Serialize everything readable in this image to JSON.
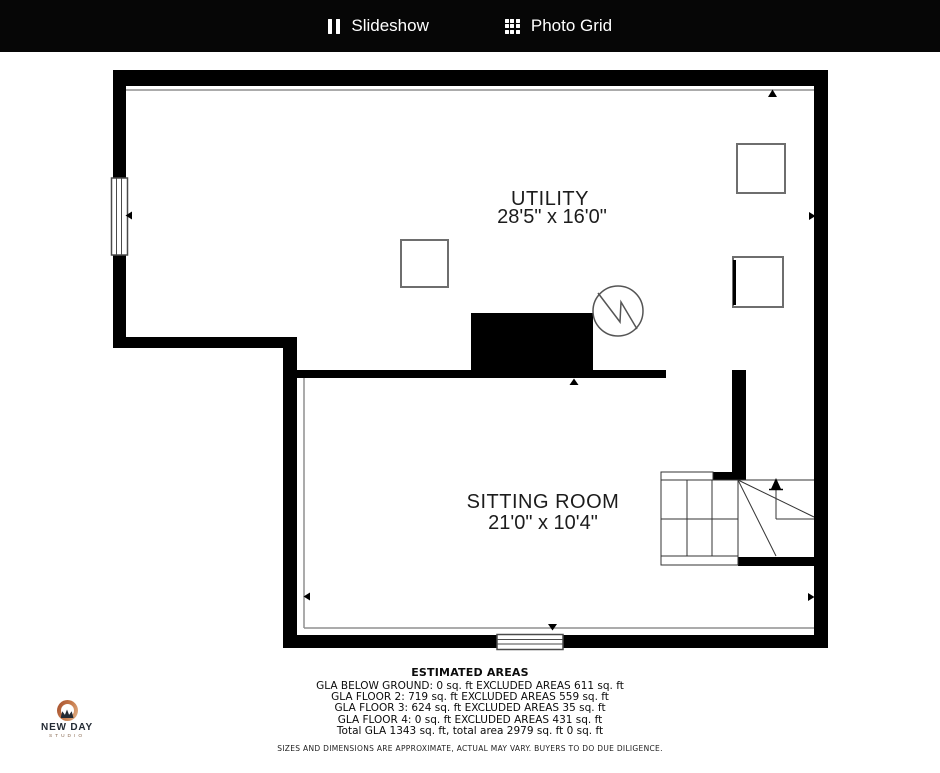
{
  "header": {
    "slideshow_label": "Slideshow",
    "photo_grid_label": "Photo Grid"
  },
  "floorplan": {
    "rooms": [
      {
        "name": "UTILITY",
        "dimensions": "28'5\" x 16'0\""
      },
      {
        "name": "SITTING ROOM",
        "dimensions": "21'0\" x 10'4\""
      }
    ]
  },
  "estimated_areas": {
    "title": "ESTIMATED AREAS",
    "lines": [
      "GLA BELOW GROUND: 0 sq. ft EXCLUDED AREAS 611 sq. ft",
      "GLA FLOOR 2: 719 sq. ft EXCLUDED AREAS 559 sq. ft",
      "GLA FLOOR 3: 624 sq. ft EXCLUDED AREAS 35 sq. ft",
      "GLA FLOOR 4: 0 sq. ft EXCLUDED AREAS 431 sq. ft",
      "Total GLA 1343 sq. ft, total area 2979 sq. ft 0 sq. ft"
    ],
    "disclaimer": "SIZES AND DIMENSIONS ARE APPROXIMATE, ACTUAL MAY VARY. BUYERS TO DO DUE DILIGENCE."
  },
  "logo": {
    "name": "NEW DAY",
    "subtitle": "STUDIO"
  },
  "colors": {
    "header_bg": "#060606",
    "wall": "#000000",
    "accent_orange": "#c0714a"
  }
}
